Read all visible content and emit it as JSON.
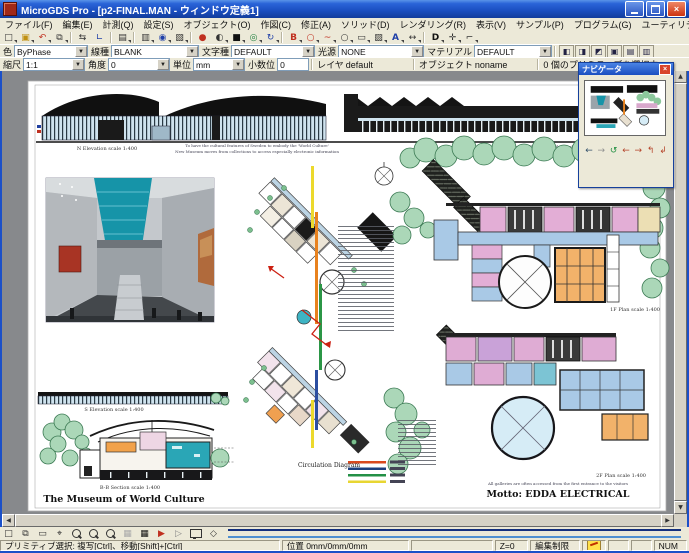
{
  "window": {
    "title": "MicroGDS Pro - [p2-FINAL.MAN - ウィンドウ定義1]"
  },
  "menu": {
    "items": [
      {
        "label": "ファイル(F)"
      },
      {
        "label": "編集(E)"
      },
      {
        "label": "計測(Q)"
      },
      {
        "label": "設定(S)"
      },
      {
        "label": "オブジェクト(O)"
      },
      {
        "label": "作図(C)"
      },
      {
        "label": "修正(A)"
      },
      {
        "label": "ソリッド(D)"
      },
      {
        "label": "レンダリング(R)"
      },
      {
        "label": "表示(V)"
      },
      {
        "label": "サンプル(P)"
      },
      {
        "label": "プログラム(G)"
      },
      {
        "label": "ユーティリティ(U)"
      },
      {
        "label": "ウィンドウ(W)"
      },
      {
        "label": "ヘルプ(H)"
      }
    ]
  },
  "toolbar1": {
    "icons": [
      {
        "name": "new",
        "glyph": "□"
      },
      {
        "name": "open",
        "glyph": "▣"
      },
      {
        "name": "undo",
        "glyph": "↶"
      },
      {
        "name": "window-set",
        "glyph": "⧉"
      },
      {
        "name": "drag-copy",
        "glyph": "⇆"
      },
      {
        "name": "polyline",
        "glyph": "∟"
      },
      {
        "name": "print-preview",
        "glyph": "▤"
      },
      {
        "name": "copy",
        "glyph": "▥"
      },
      {
        "name": "attach",
        "glyph": "◉"
      },
      {
        "name": "paste",
        "glyph": "▧"
      },
      {
        "name": "render",
        "glyph": "●"
      },
      {
        "name": "material-sphere",
        "glyph": "◐"
      },
      {
        "name": "solid-box",
        "glyph": "■"
      },
      {
        "name": "camera-view",
        "glyph": "◎"
      },
      {
        "name": "rotate-view",
        "glyph": "↻"
      },
      {
        "name": "phase",
        "glyph": "B"
      },
      {
        "name": "circle",
        "glyph": "○"
      },
      {
        "name": "arc",
        "glyph": "~"
      },
      {
        "name": "ellipse",
        "glyph": "○"
      },
      {
        "name": "rectangle",
        "glyph": "▭"
      },
      {
        "name": "hatch",
        "glyph": "▨"
      },
      {
        "name": "text",
        "glyph": "A"
      },
      {
        "name": "dimension",
        "glyph": "↔"
      },
      {
        "name": "database",
        "glyph": "D"
      },
      {
        "name": "tools",
        "glyph": "✛"
      },
      {
        "name": "key",
        "glyph": "⌐"
      }
    ]
  },
  "toolbar2": {
    "color_label": "色",
    "color_value": "ByPhase",
    "linetype_label": "線種",
    "linetype_value": "BLANK",
    "textstyle_label": "文字種",
    "textstyle_value": "DEFAULT",
    "light_label": "光源",
    "light_value": "NONE",
    "material_label": "マテリアル",
    "material_value": "DEFAULT",
    "toggles": [
      {
        "name": "phase-toggle-1",
        "glyph": "◧"
      },
      {
        "name": "phase-toggle-2",
        "glyph": "◨"
      },
      {
        "name": "phase-toggle-3",
        "glyph": "◩"
      },
      {
        "name": "phase-toggle-4",
        "glyph": "▣"
      },
      {
        "name": "phase-toggle-5",
        "glyph": "▤"
      },
      {
        "name": "phase-toggle-6",
        "glyph": "▥"
      }
    ]
  },
  "toolbar3": {
    "scale_label": "縮尺",
    "scale_value": "1:1",
    "angle_label": "角度",
    "angle_value": "0",
    "unit_label": "単位",
    "unit_value": "mm",
    "decimal_label": "小数位",
    "decimal_value": "0",
    "layer_label": "レイヤ",
    "layer_value": "default",
    "object_label": "オブジェクト",
    "object_value": "noname",
    "selection_status": "0 個のプリミティブを選択中"
  },
  "navigator": {
    "title": "ナビゲータ",
    "close": "×",
    "buttons": [
      {
        "name": "nav-back",
        "glyph": "←"
      },
      {
        "name": "nav-forward",
        "glyph": "→"
      },
      {
        "name": "nav-refresh",
        "glyph": "↺"
      },
      {
        "name": "nav-left",
        "glyph": "←"
      },
      {
        "name": "nav-right",
        "glyph": "→"
      },
      {
        "name": "nav-up",
        "glyph": "↰"
      },
      {
        "name": "nav-down",
        "glyph": "↲"
      }
    ]
  },
  "drawing": {
    "titles": {
      "museum": "The Museum of World Culture",
      "motto": "Motto:  EDDA ELECTRICAL"
    },
    "captions": {
      "n_elevation": "N Elevation  scale 1:400",
      "s_elevation": "S Elevation  scale 1:400",
      "bb_section": "B-B Section  scale 1:400",
      "plan_upper": "1F Plan  scale 1:400",
      "plan_lower": "2F Plan  scale 1:400"
    },
    "notes": {
      "top_left_1": "To have the cultural features of Sweden to embody the 'World Culture'",
      "top_left_2": "New Museum moves from collections to access especially electronic information",
      "top_right_1": "Central Mall remains with full of skylight at the center",
      "top_right_2": "of the building as the spine of the facility and the demonstration",
      "bottom_right": "All galleries are often accessed from the first entrance to the visitors"
    },
    "legend": {
      "title": "Circulation Diagram",
      "colors": [
        "#d94a1e",
        "#1d3f7e",
        "#239046",
        "#e8d632"
      ]
    }
  },
  "bottom_toolbar": {
    "icons": [
      {
        "name": "select-primitive",
        "glyph": "□"
      },
      {
        "name": "select-overlap",
        "glyph": "⧉"
      },
      {
        "name": "select-window",
        "glyph": "▭"
      },
      {
        "name": "snap-target",
        "glyph": "⌖"
      },
      {
        "name": "grid-off",
        "glyph": "▦"
      },
      {
        "name": "grid-on",
        "glyph": "▦"
      },
      {
        "name": "redraw",
        "glyph": "▶"
      },
      {
        "name": "pointer",
        "glyph": "▷"
      },
      {
        "name": "phase-select",
        "glyph": "◇"
      }
    ]
  },
  "statusbar": {
    "hint": "プリミティブ選択: 複写[Ctrl]、移動[Shift]+[Ctrl]",
    "position_label": "位置",
    "position_value": "0mm/0mm/0mm",
    "z_value": "Z=0",
    "edit_limit": "編集制限",
    "num_lock": "NUM"
  }
}
